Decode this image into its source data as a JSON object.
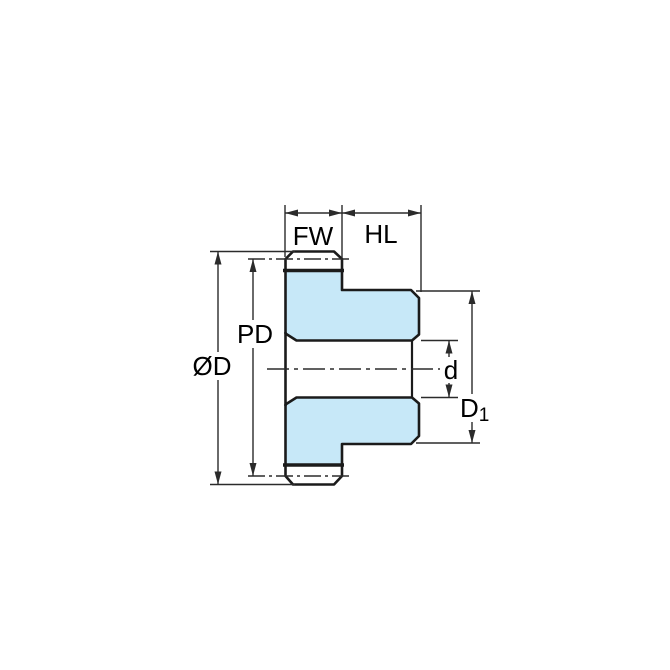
{
  "diagram": {
    "labels": {
      "face_width": "FW",
      "hub_length": "HL",
      "pitch_diameter": "PD",
      "outer_diameter": "ØD",
      "bore_diameter": "d",
      "hub_diameter_main": "D",
      "hub_diameter_sub": "1"
    },
    "colors": {
      "part_fill": "#C7E8F8",
      "outline": "#1B1B1B",
      "thin_line": "#2B2B2B",
      "background": "#FFFFFF",
      "text": "#000000"
    }
  }
}
